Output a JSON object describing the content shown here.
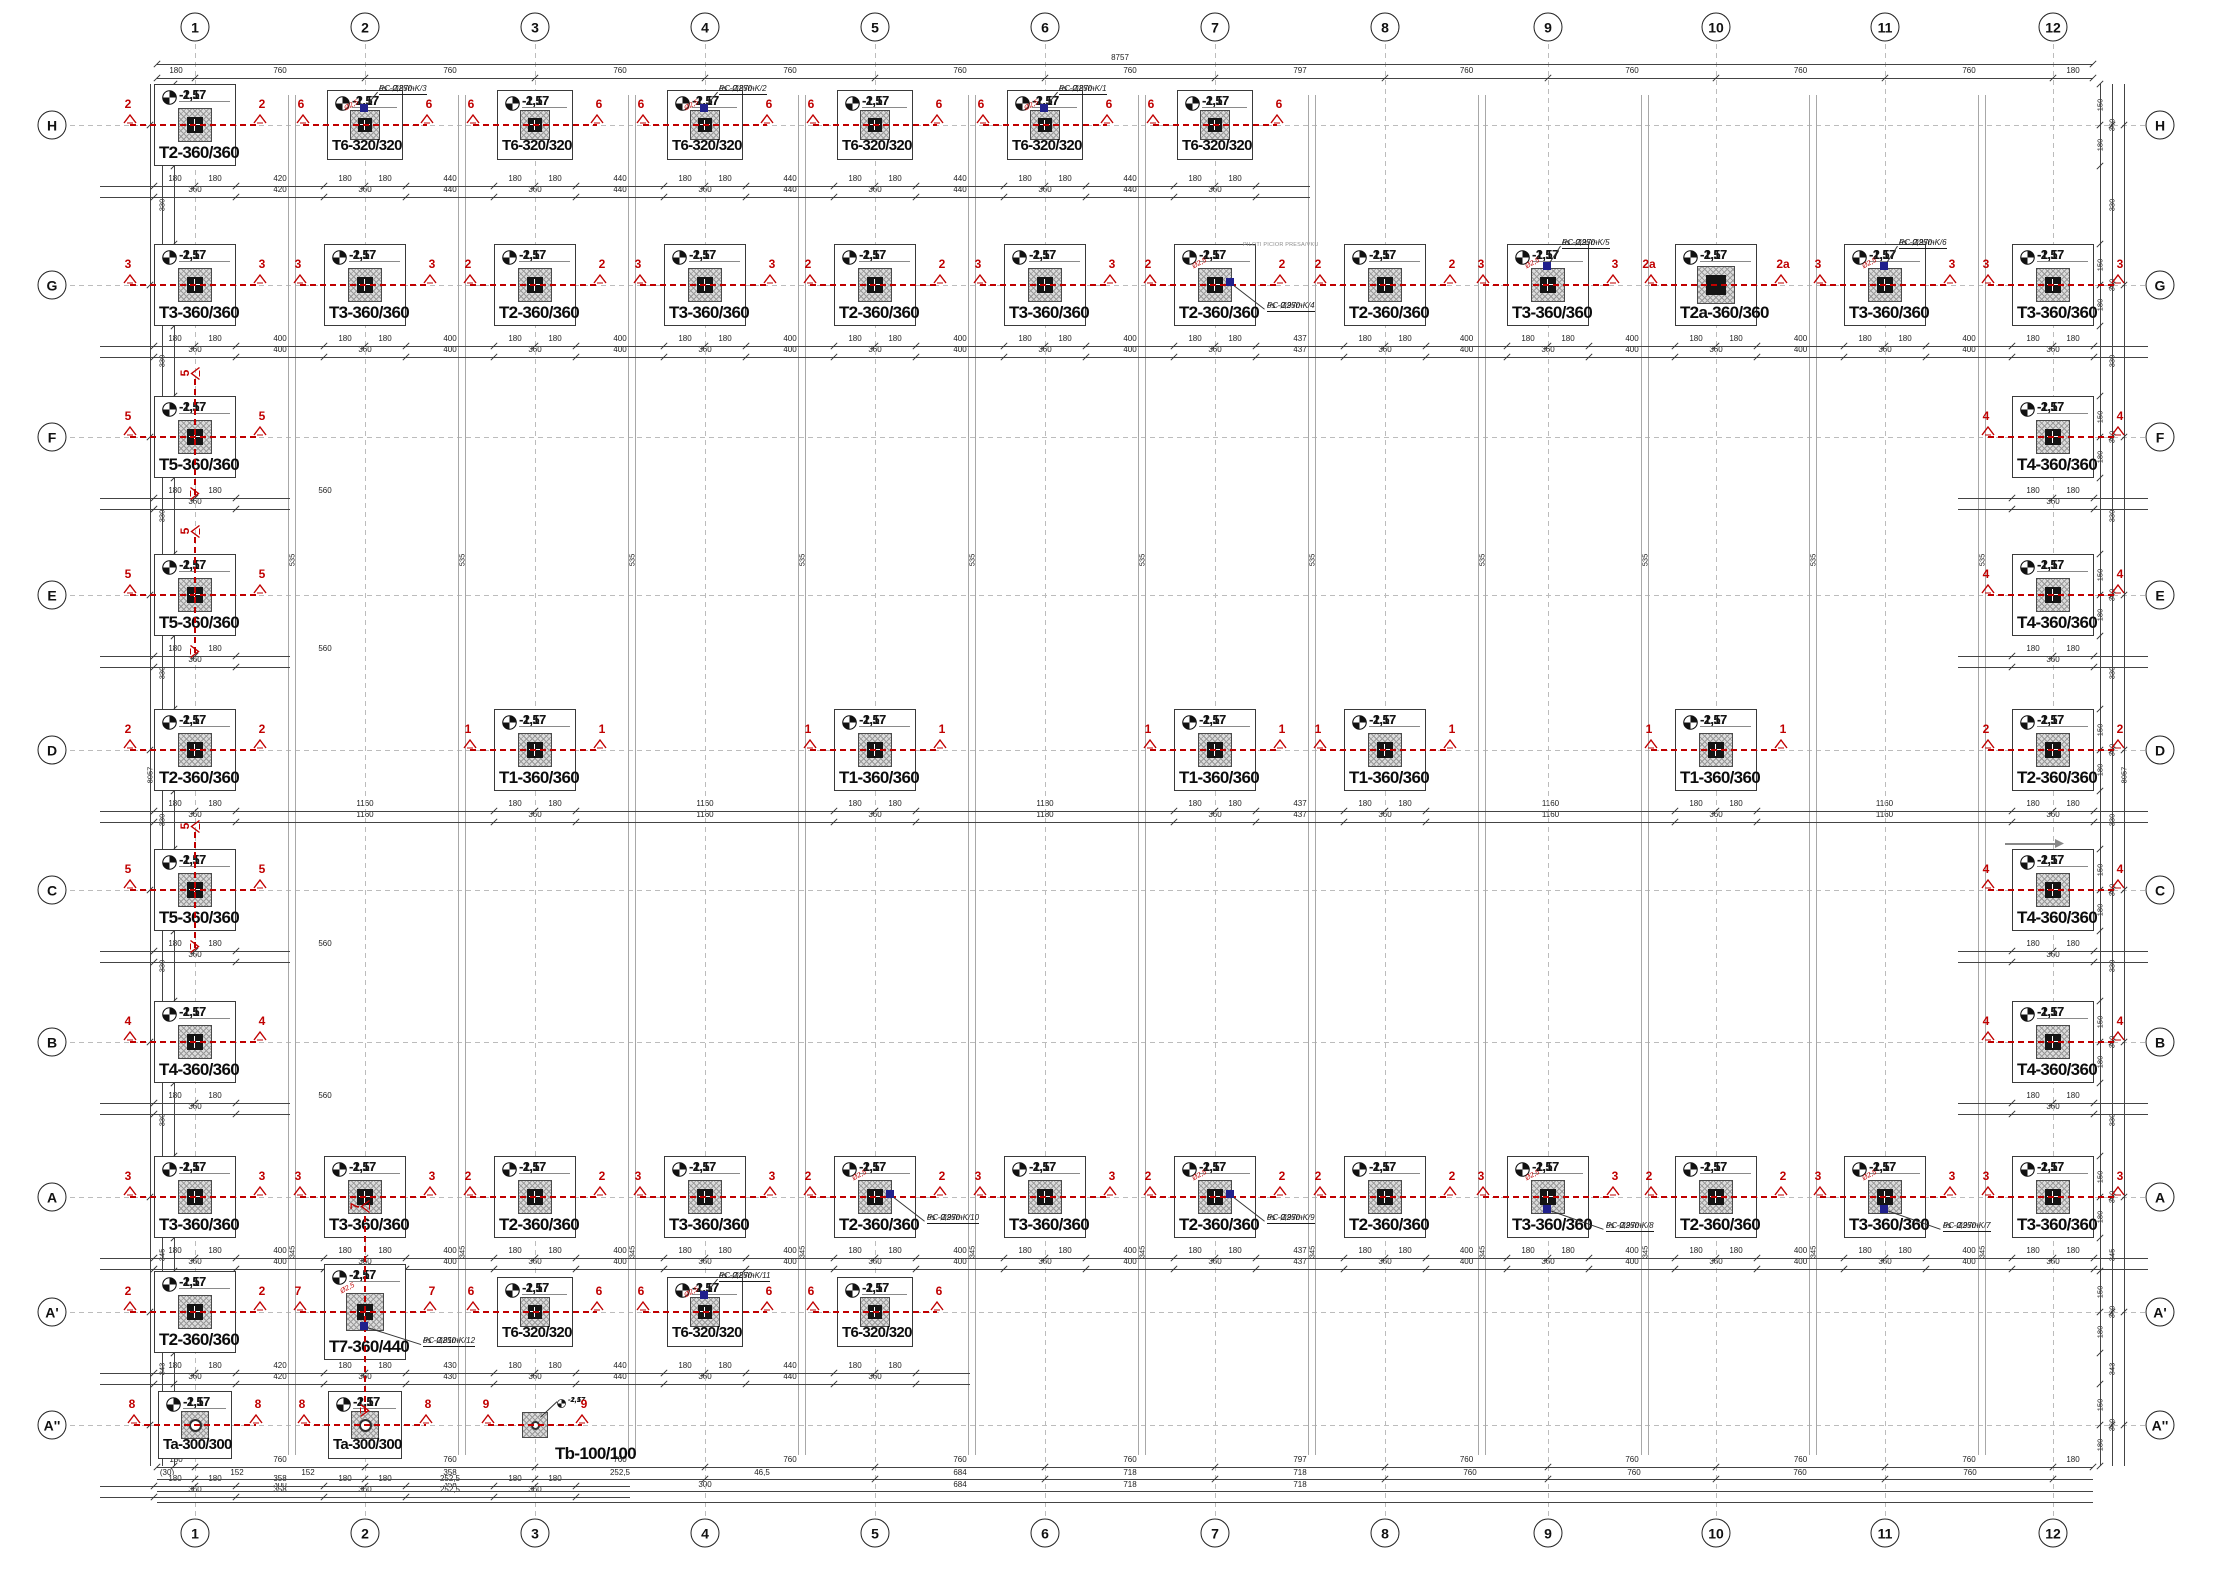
{
  "sheet": {
    "width": 2214,
    "height": 1584
  },
  "colors": {
    "line": "#3a3a3a",
    "grid": "#bcbcbc",
    "red": "#c00000",
    "blue": "#20208c",
    "hatch_bg": "#dcdcdc",
    "hatch_fg": "#9a9a9a",
    "text": "#111111"
  },
  "levels": {
    "upper": "-1,57",
    "lower": "-2,17"
  },
  "grid": {
    "cols": [
      [
        "1",
        195
      ],
      [
        "2",
        365
      ],
      [
        "3",
        535
      ],
      [
        "4",
        705
      ],
      [
        "5",
        875
      ],
      [
        "6",
        1045
      ],
      [
        "7",
        1215
      ],
      [
        "8",
        1385
      ],
      [
        "9",
        1548
      ],
      [
        "10",
        1716
      ],
      [
        "11",
        1885
      ],
      [
        "12",
        2053
      ]
    ],
    "rows": [
      [
        "H",
        125
      ],
      [
        "G",
        285
      ],
      [
        "F",
        437
      ],
      [
        "E",
        595
      ],
      [
        "D",
        750
      ],
      [
        "C",
        890
      ],
      [
        "B",
        1042
      ],
      [
        "A",
        1197
      ],
      [
        "A'",
        1312
      ],
      [
        "A''",
        1425
      ]
    ]
  },
  "dims": {
    "overall_top": "8757",
    "overall_left": "8057",
    "top_bays": [
      "180",
      "760",
      "760",
      "760",
      "760",
      "760",
      "760",
      "797",
      "760",
      "760",
      "760",
      "760",
      "180"
    ],
    "left_gaps": [
      "330",
      "330",
      "330",
      "330",
      "330",
      "330",
      "330",
      "345",
      "343"
    ],
    "left_row_val": "360",
    "left_near": [
      "150",
      "180"
    ],
    "pair_upper": "535",
    "pair_lower": "345",
    "row_near": [
      "180",
      "180"
    ],
    "row_center": "360",
    "row_gaps": {
      "H": [
        "420",
        "440",
        "440",
        "440",
        "440",
        "440"
      ],
      "G": [
        "400",
        "400",
        "400",
        "400",
        "400",
        "400",
        "437",
        "400",
        "400",
        "400",
        "400"
      ],
      "F": [
        "560"
      ],
      "E": [
        "560"
      ],
      "C": [
        "560"
      ],
      "B": [
        "560"
      ],
      "D": [
        "1160",
        "1160",
        "1180",
        "437",
        "1160",
        "1160"
      ],
      "A": [
        "400",
        "400",
        "400",
        "400",
        "400",
        "400",
        "437",
        "400",
        "400",
        "400",
        "400"
      ],
      "A'": [
        "420",
        "430",
        "440",
        "440"
      ],
      "A''": [
        "358",
        "252,5"
      ]
    },
    "bottom_line2": [
      [
        167,
        "(30)"
      ],
      [
        237,
        "152"
      ],
      [
        308,
        "152"
      ],
      [
        450,
        "358"
      ],
      [
        620,
        "252,5"
      ],
      [
        762,
        "46,5"
      ],
      [
        960,
        "684"
      ],
      [
        1130,
        "718"
      ],
      [
        1300,
        "718"
      ],
      [
        1470,
        "760"
      ],
      [
        1634,
        "760"
      ],
      [
        1800,
        "760"
      ],
      [
        1970,
        "760"
      ]
    ],
    "bottom_line3": [
      [
        280,
        "300"
      ],
      [
        450,
        "358"
      ],
      [
        705,
        "300"
      ],
      [
        960,
        "684"
      ],
      [
        1130,
        "718"
      ],
      [
        1300,
        "718"
      ]
    ]
  },
  "notes": {
    "gray_note_g7": "PILOTI PICIOR PRESA/VKU"
  },
  "footings": [
    {
      "r": "H",
      "c": "1",
      "t": "T2-360/360",
      "m": "2",
      "k": "std"
    },
    {
      "r": "H",
      "c": "2",
      "t": "T6-320/320",
      "m": "6",
      "k": "t6",
      "p": "top",
      "n": [
        "PC Ø250-K/3",
        "os -0,87m"
      ]
    },
    {
      "r": "H",
      "c": "3",
      "t": "T6-320/320",
      "m": "6",
      "k": "t6"
    },
    {
      "r": "H",
      "c": "4",
      "t": "T6-320/320",
      "m": "6",
      "k": "t6",
      "p": "top",
      "n": [
        "PC Ø250-K/2",
        "os -0,87m"
      ]
    },
    {
      "r": "H",
      "c": "5",
      "t": "T6-320/320",
      "m": "6",
      "k": "t6"
    },
    {
      "r": "H",
      "c": "6",
      "t": "T6-320/320",
      "m": "6",
      "k": "t6",
      "p": "top",
      "n": [
        "PC Ø250-K/1",
        "os -0,87m"
      ]
    },
    {
      "r": "H",
      "c": "7",
      "t": "T6-320/320",
      "m": "6",
      "k": "t6"
    },
    {
      "r": "G",
      "c": "1",
      "t": "T3-360/360",
      "m": "3",
      "k": "std"
    },
    {
      "r": "G",
      "c": "2",
      "t": "T3-360/360",
      "m": "3",
      "k": "std"
    },
    {
      "r": "G",
      "c": "3",
      "t": "T2-360/360",
      "m": "2",
      "k": "std"
    },
    {
      "r": "G",
      "c": "4",
      "t": "T3-360/360",
      "m": "3",
      "k": "std"
    },
    {
      "r": "G",
      "c": "5",
      "t": "T2-360/360",
      "m": "2",
      "k": "std"
    },
    {
      "r": "G",
      "c": "6",
      "t": "T3-360/360",
      "m": "3",
      "k": "std"
    },
    {
      "r": "G",
      "c": "7",
      "t": "T2-360/360",
      "m": "2",
      "k": "std",
      "p": "right",
      "n": [
        "PC Ø250-K/4",
        "os -0,97m"
      ],
      "g": true
    },
    {
      "r": "G",
      "c": "8",
      "t": "T2-360/360",
      "m": "2",
      "k": "std"
    },
    {
      "r": "G",
      "c": "9",
      "t": "T3-360/360",
      "m": "3",
      "k": "std",
      "p": "top",
      "n": [
        "PC Ø250-K/5",
        "os -0,97m"
      ]
    },
    {
      "r": "G",
      "c": "10",
      "t": "T2a-360/360",
      "m": "2a",
      "k": "t2a"
    },
    {
      "r": "G",
      "c": "11",
      "t": "T3-360/360",
      "m": "3",
      "k": "std",
      "p": "top",
      "n": [
        "PC Ø250-K/6",
        "os -0,97m"
      ]
    },
    {
      "r": "G",
      "c": "12",
      "t": "T3-360/360",
      "m": "3",
      "k": "std"
    },
    {
      "r": "F",
      "c": "1",
      "t": "T5-360/360",
      "m": "5",
      "k": "t5"
    },
    {
      "r": "F",
      "c": "12",
      "t": "T4-360/360",
      "m": "4",
      "k": "std"
    },
    {
      "r": "E",
      "c": "1",
      "t": "T5-360/360",
      "m": "5",
      "k": "t5"
    },
    {
      "r": "E",
      "c": "12",
      "t": "T4-360/360",
      "m": "4",
      "k": "std"
    },
    {
      "r": "D",
      "c": "1",
      "t": "T2-360/360",
      "m": "2",
      "k": "std"
    },
    {
      "r": "D",
      "c": "3",
      "t": "T1-360/360",
      "m": "1",
      "k": "std"
    },
    {
      "r": "D",
      "c": "5",
      "t": "T1-360/360",
      "m": "1",
      "k": "std"
    },
    {
      "r": "D",
      "c": "7",
      "t": "T1-360/360",
      "m": "1",
      "k": "std"
    },
    {
      "r": "D",
      "c": "8",
      "t": "T1-360/360",
      "m": "1",
      "k": "std"
    },
    {
      "r": "D",
      "c": "10",
      "t": "T1-360/360",
      "m": "1",
      "k": "std"
    },
    {
      "r": "D",
      "c": "12",
      "t": "T2-360/360",
      "m": "2",
      "k": "std"
    },
    {
      "r": "C",
      "c": "1",
      "t": "T5-360/360",
      "m": "5",
      "k": "t5"
    },
    {
      "r": "C",
      "c": "12",
      "t": "T4-360/360",
      "m": "4",
      "k": "std",
      "arrow": true
    },
    {
      "r": "B",
      "c": "1",
      "t": "T4-360/360",
      "m": "4",
      "k": "std"
    },
    {
      "r": "B",
      "c": "12",
      "t": "T4-360/360",
      "m": "4",
      "k": "std"
    },
    {
      "r": "A",
      "c": "1",
      "t": "T3-360/360",
      "m": "3",
      "k": "std"
    },
    {
      "r": "A",
      "c": "2",
      "t": "T3-360/360",
      "m": "3",
      "k": "std"
    },
    {
      "r": "A",
      "c": "3",
      "t": "T2-360/360",
      "m": "2",
      "k": "std"
    },
    {
      "r": "A",
      "c": "4",
      "t": "T3-360/360",
      "m": "3",
      "k": "std"
    },
    {
      "r": "A",
      "c": "5",
      "t": "T2-360/360",
      "m": "2",
      "k": "std",
      "p": "right",
      "n": [
        "PC Ø250-K/10",
        "os -0,97m"
      ]
    },
    {
      "r": "A",
      "c": "6",
      "t": "T3-360/360",
      "m": "3",
      "k": "std"
    },
    {
      "r": "A",
      "c": "7",
      "t": "T2-360/360",
      "m": "2",
      "k": "std",
      "p": "right",
      "n": [
        "PC Ø250-K/9",
        "os -0,97m"
      ]
    },
    {
      "r": "A",
      "c": "8",
      "t": "T2-360/360",
      "m": "2",
      "k": "std"
    },
    {
      "r": "A",
      "c": "9",
      "t": "T3-360/360",
      "m": "3",
      "k": "std",
      "p": "bottom",
      "n": [
        "PC Ø250-K/8",
        "os -0,97m"
      ]
    },
    {
      "r": "A",
      "c": "10",
      "t": "T2-360/360",
      "m": "2",
      "k": "std"
    },
    {
      "r": "A",
      "c": "11",
      "t": "T3-360/360",
      "m": "3",
      "k": "std",
      "p": "bottom",
      "n": [
        "PC Ø250-K/7",
        "os -0,97m"
      ]
    },
    {
      "r": "A",
      "c": "12",
      "t": "T3-360/360",
      "m": "3",
      "k": "std"
    },
    {
      "r": "A'",
      "c": "1",
      "t": "T2-360/360",
      "m": "2",
      "k": "std"
    },
    {
      "r": "A'",
      "c": "2",
      "t": "T7-360/440",
      "m": "7",
      "k": "t7",
      "p": "bottom",
      "n": [
        "PC Ø250-K/12",
        "os -0,81m"
      ]
    },
    {
      "r": "A'",
      "c": "3",
      "t": "T6-320/320",
      "m": "6",
      "k": "t6"
    },
    {
      "r": "A'",
      "c": "4",
      "t": "T6-320/320",
      "m": "6",
      "k": "t6",
      "p": "top",
      "n": [
        "PC Ø250-K/11",
        "os -0,87m"
      ]
    },
    {
      "r": "A'",
      "c": "5",
      "t": "T6-320/320",
      "m": "6",
      "k": "t6"
    },
    {
      "r": "A''",
      "c": "1",
      "t": "Ta-300/300",
      "m": "8",
      "k": "ta"
    },
    {
      "r": "A''",
      "c": "2",
      "t": "Ta-300/300",
      "m": "8",
      "k": "ta"
    },
    {
      "r": "A''",
      "c": "3",
      "t": "Tb-100/100",
      "m": "9",
      "k": "tb"
    }
  ]
}
